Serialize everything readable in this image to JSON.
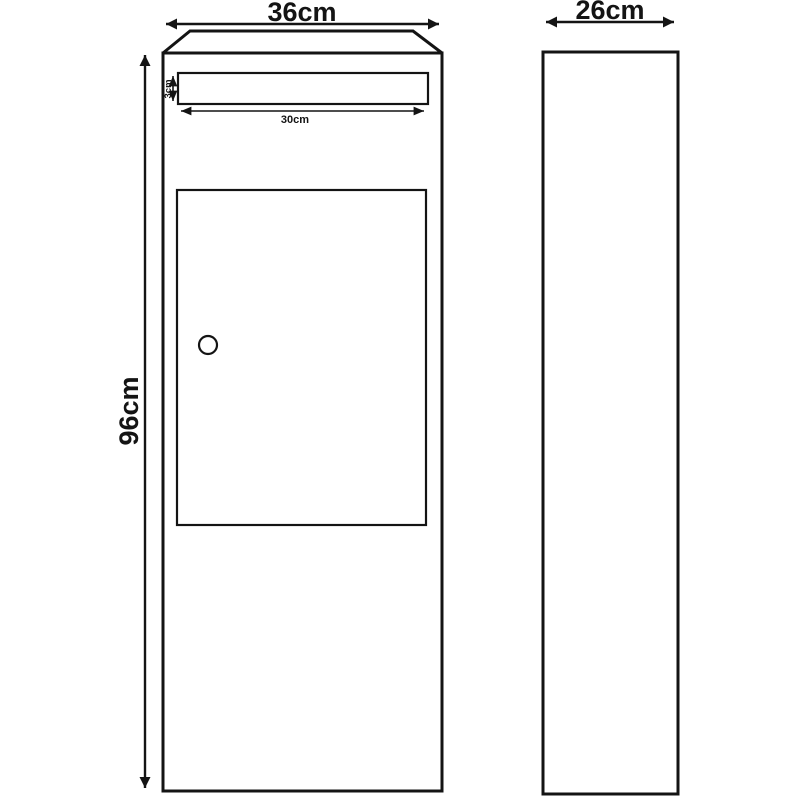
{
  "diagram": {
    "type": "technical-drawing",
    "subject": "parcel letterbox front and side elevations with dimensions",
    "front_view": {
      "width_label": "36cm",
      "height_label": "96cm",
      "slot": {
        "height_label": "3cm",
        "width_label": "30cm"
      }
    },
    "side_view": {
      "depth_label": "26cm"
    },
    "colors": {
      "line": "#141414",
      "background": "#ffffff"
    }
  }
}
